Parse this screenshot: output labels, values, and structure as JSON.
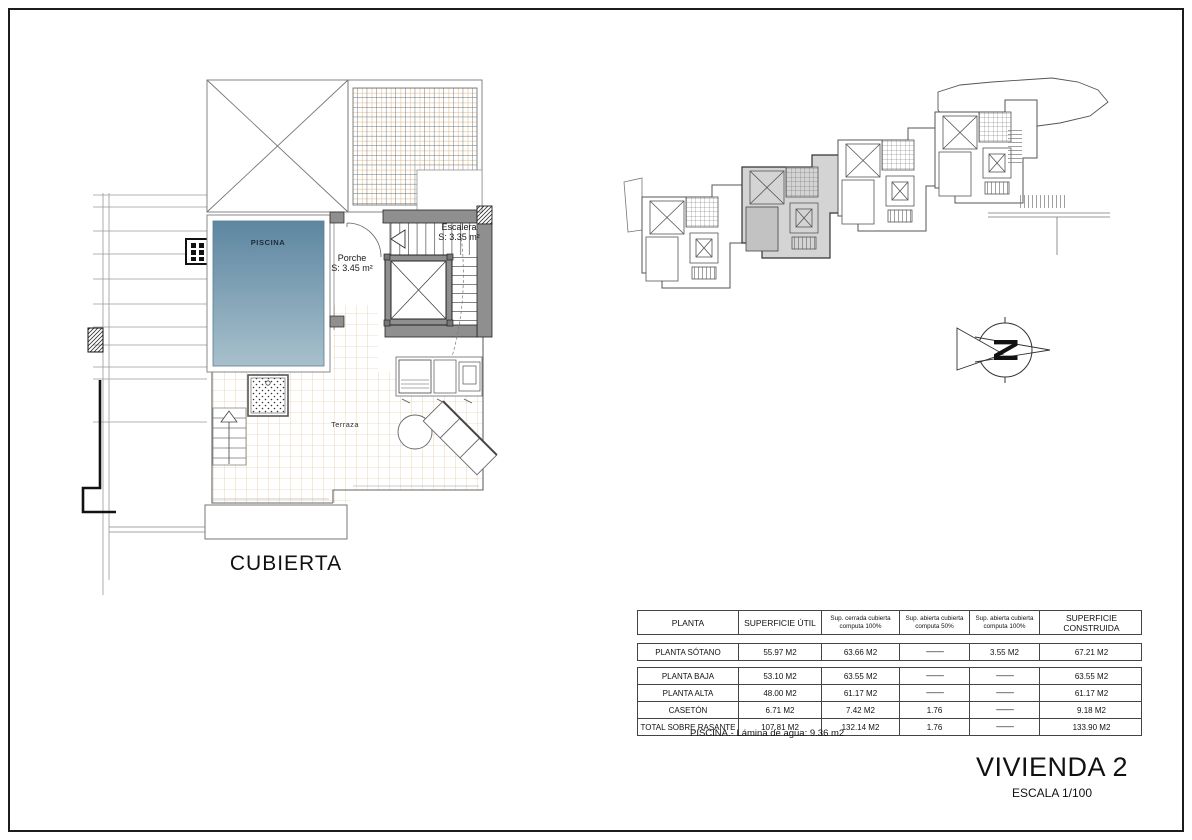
{
  "drawing": {
    "floor_plan_title": "CUBIERTA",
    "labels": {
      "pool": "PISCINA",
      "porch_name": "Porche",
      "porch_area": "S: 3.45 m²",
      "stairs_name": "Escalera",
      "stairs_area": "S: 3.35 m²",
      "terrace": "Terraza"
    }
  },
  "title_block": {
    "title": "VIVIENDA 2",
    "scale": "ESCALA 1/100"
  },
  "area_table": {
    "headers": [
      "PLANTA",
      "SUPERFICIE ÚTIL",
      "Sup. cerrada cubierta computa 100%",
      "Sup. abierta cubierta computa 50%",
      "Sup. abierta cubierta computa 100%",
      "SUPERFICIE CONSTRUIDA"
    ],
    "sotano_row": [
      "PLANTA SÓTANO",
      "55.97 M2",
      "63.66 M2",
      "-------------",
      "3.55 M2",
      "67.21 M2"
    ],
    "rows": [
      [
        "PLANTA BAJA",
        "53.10 M2",
        "63.55 M2",
        "-------------",
        "-------------",
        "63.55 M2"
      ],
      [
        "PLANTA ALTA",
        "48.00 M2",
        "61.17 M2",
        "-------------",
        "-------------",
        "61.17 M2"
      ],
      [
        "CASETÓN",
        "6.71 M2",
        "7.42 M2",
        "1.76",
        "-------------",
        "9.18 M2"
      ],
      [
        "TOTAL SOBRE RASANTE",
        "107.81 M2",
        "132.14 M2",
        "1.76",
        "-------------",
        "133.90 M2"
      ]
    ],
    "footnote": "PISCINA.- Lámina de agua: 9.36 m2"
  },
  "colors": {
    "pool_top": "#5d86a1",
    "pool_bottom": "#a8c0cc",
    "terrace_grid": "#ddba8e",
    "wall_gray": "#8f8f8f",
    "highlight_unit": "#d4d4d4",
    "line_dark": "#444444"
  }
}
